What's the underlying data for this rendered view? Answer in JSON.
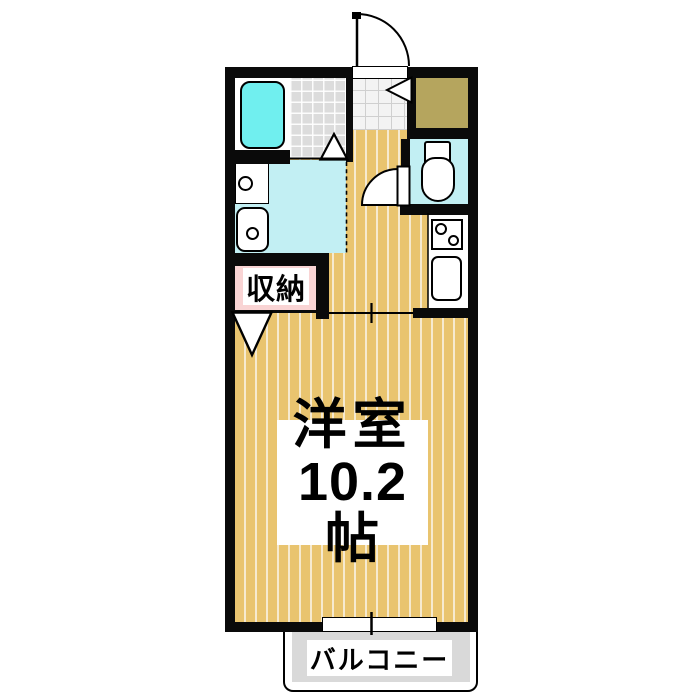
{
  "labels": {
    "main_room_name": "洋室",
    "main_room_size": "10.2帖",
    "closet": "収納",
    "balcony": "バルコニー"
  },
  "colors": {
    "wood": "#e9c46f",
    "wood_stripe": "#f6ead0",
    "wall": "#0a0a0a",
    "bathtub": "#70efef",
    "wet_floor": "#c2eff3",
    "tile_gray": "#dcdcdc",
    "entry_tile": "#f3f3f3",
    "entry_step": "#b5a55e",
    "closet_fill": "#f9d4d4",
    "balcony_floor": "#d9d9d9"
  },
  "icons": {
    "bathtub": "bathtub-icon",
    "vanity": "vanity-sink-icon",
    "washing_machine": "washing-machine-icon",
    "toilet": "toilet-icon",
    "stove": "stove-burners-icon",
    "kitchen_sink": "kitchen-sink-icon",
    "entrance_door": "door-swing-icon",
    "toilet_door": "door-swing-icon",
    "window": "sliding-window-icon"
  }
}
